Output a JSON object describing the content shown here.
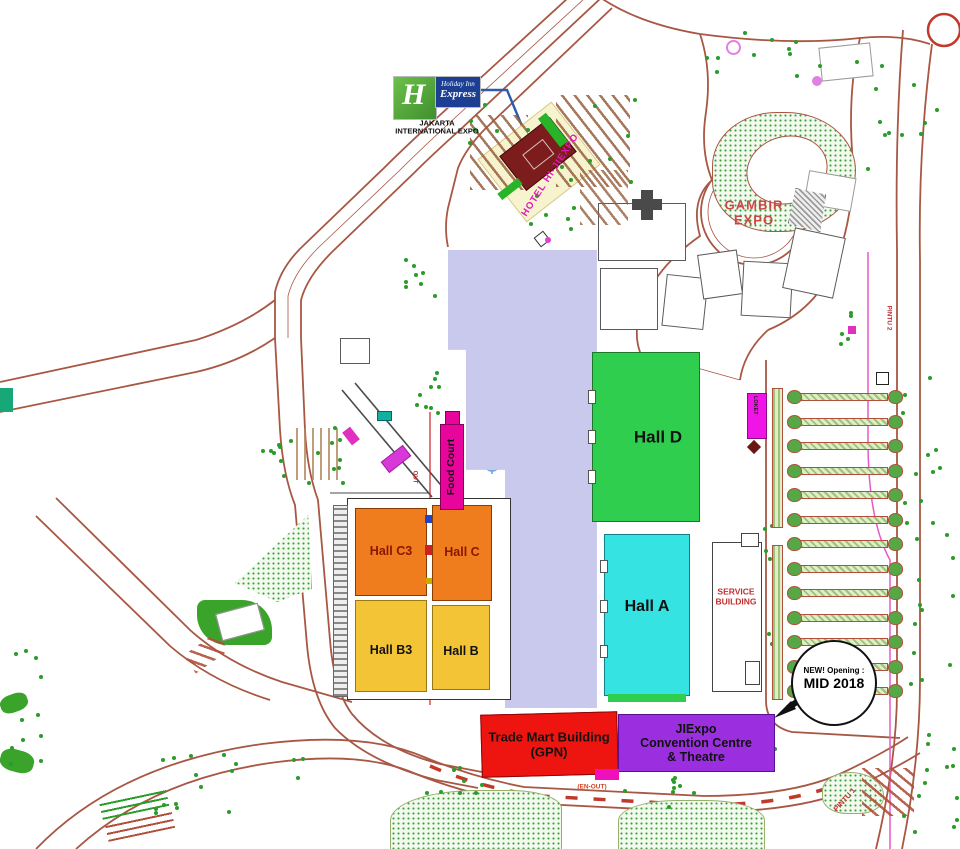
{
  "map": {
    "hotel_brand": {
      "h_glyph": "H",
      "name_line1": "Holiday Inn",
      "name_line2": "Express"
    },
    "subtitle": {
      "line1": "JAKARTA",
      "line2": "INTERNATIONAL EXPO"
    },
    "labels": {
      "hotel": "HOTEL HI-JIEXPO",
      "gambir_line1": "GAMBIR",
      "gambir_line2": "EXPO",
      "open_space": "Open Space",
      "hall_d": "Hall D",
      "hall_a": "Hall A",
      "hall_c3": "Hall C3",
      "hall_c": "Hall C",
      "hall_b3": "Hall B3",
      "hall_b": "Hall B",
      "food_court": "Food Court",
      "service_line1": "SERVICE",
      "service_line2": "BUILDING",
      "trade_mart_line1": "Trade Mart Building",
      "trade_mart_line2": "(GPN)",
      "convention_line1": "JIExpo",
      "convention_line2": "Convention Centre",
      "convention_line3": "& Theatre",
      "new_badge_line1": "NEW! Opening :",
      "new_badge_line2": "MID 2018",
      "gate_pintu1": "PINTU 1",
      "gate_pintu2": "PINTU 2",
      "en_out": "(EN-OUT)",
      "out": "OUT",
      "loket": "LOKET"
    },
    "colors": {
      "hall_d": "#2fce4e",
      "hall_a": "#35e3e3",
      "hall_c": "#ef7d1e",
      "hall_b": "#f3c435",
      "food_court": "#e8059c",
      "trade_mart": "#ee1511",
      "convention": "#9b2fe0",
      "open_space": "#c9c9ed",
      "hotel": "#7d1c1c",
      "road": "#a85743",
      "brand_green": "#49a942",
      "brand_blue": "#1c3f94",
      "gate_text": "#c03030"
    },
    "tree_clusters": [
      {
        "x": 398,
        "y": 258,
        "w": 38,
        "h": 46,
        "n": 8,
        "seed": 1
      },
      {
        "x": 412,
        "y": 362,
        "w": 26,
        "h": 62,
        "n": 9,
        "seed": 2
      },
      {
        "x": 300,
        "y": 425,
        "w": 52,
        "h": 58,
        "n": 9,
        "seed": 3
      },
      {
        "x": 240,
        "y": 436,
        "w": 60,
        "h": 44,
        "n": 8,
        "seed": 4
      },
      {
        "x": 462,
        "y": 96,
        "w": 64,
        "h": 52,
        "n": 7,
        "seed": 5
      },
      {
        "x": 560,
        "y": 96,
        "w": 80,
        "h": 90,
        "n": 8,
        "seed": 6
      },
      {
        "x": 700,
        "y": 28,
        "w": 170,
        "h": 46,
        "n": 12,
        "seed": 7
      },
      {
        "x": 862,
        "y": 64,
        "w": 86,
        "h": 120,
        "n": 11,
        "seed": 8
      },
      {
        "x": 900,
        "y": 368,
        "w": 52,
        "h": 330,
        "n": 24,
        "seed": 9
      },
      {
        "x": 758,
        "y": 520,
        "w": 16,
        "h": 175,
        "n": 7,
        "seed": 10
      },
      {
        "x": 148,
        "y": 752,
        "w": 165,
        "h": 62,
        "n": 17,
        "seed": 11
      },
      {
        "x": 425,
        "y": 762,
        "w": 62,
        "h": 34,
        "n": 8,
        "seed": 12
      },
      {
        "x": 622,
        "y": 772,
        "w": 72,
        "h": 46,
        "n": 9,
        "seed": 13
      },
      {
        "x": 714,
        "y": 712,
        "w": 72,
        "h": 52,
        "n": 9,
        "seed": 14
      },
      {
        "x": 898,
        "y": 716,
        "w": 58,
        "h": 120,
        "n": 13,
        "seed": 15
      },
      {
        "x": 8,
        "y": 636,
        "w": 34,
        "h": 150,
        "n": 11,
        "seed": 16
      },
      {
        "x": 520,
        "y": 186,
        "w": 54,
        "h": 60,
        "n": 6,
        "seed": 17
      },
      {
        "x": 836,
        "y": 296,
        "w": 20,
        "h": 60,
        "n": 5,
        "seed": 18
      }
    ],
    "parking": {
      "rows": 13,
      "x_bar": 800,
      "bar_w": 88,
      "cap_left": 787,
      "cap_right": 888,
      "y_start": 390,
      "y_step": 24.5
    }
  }
}
